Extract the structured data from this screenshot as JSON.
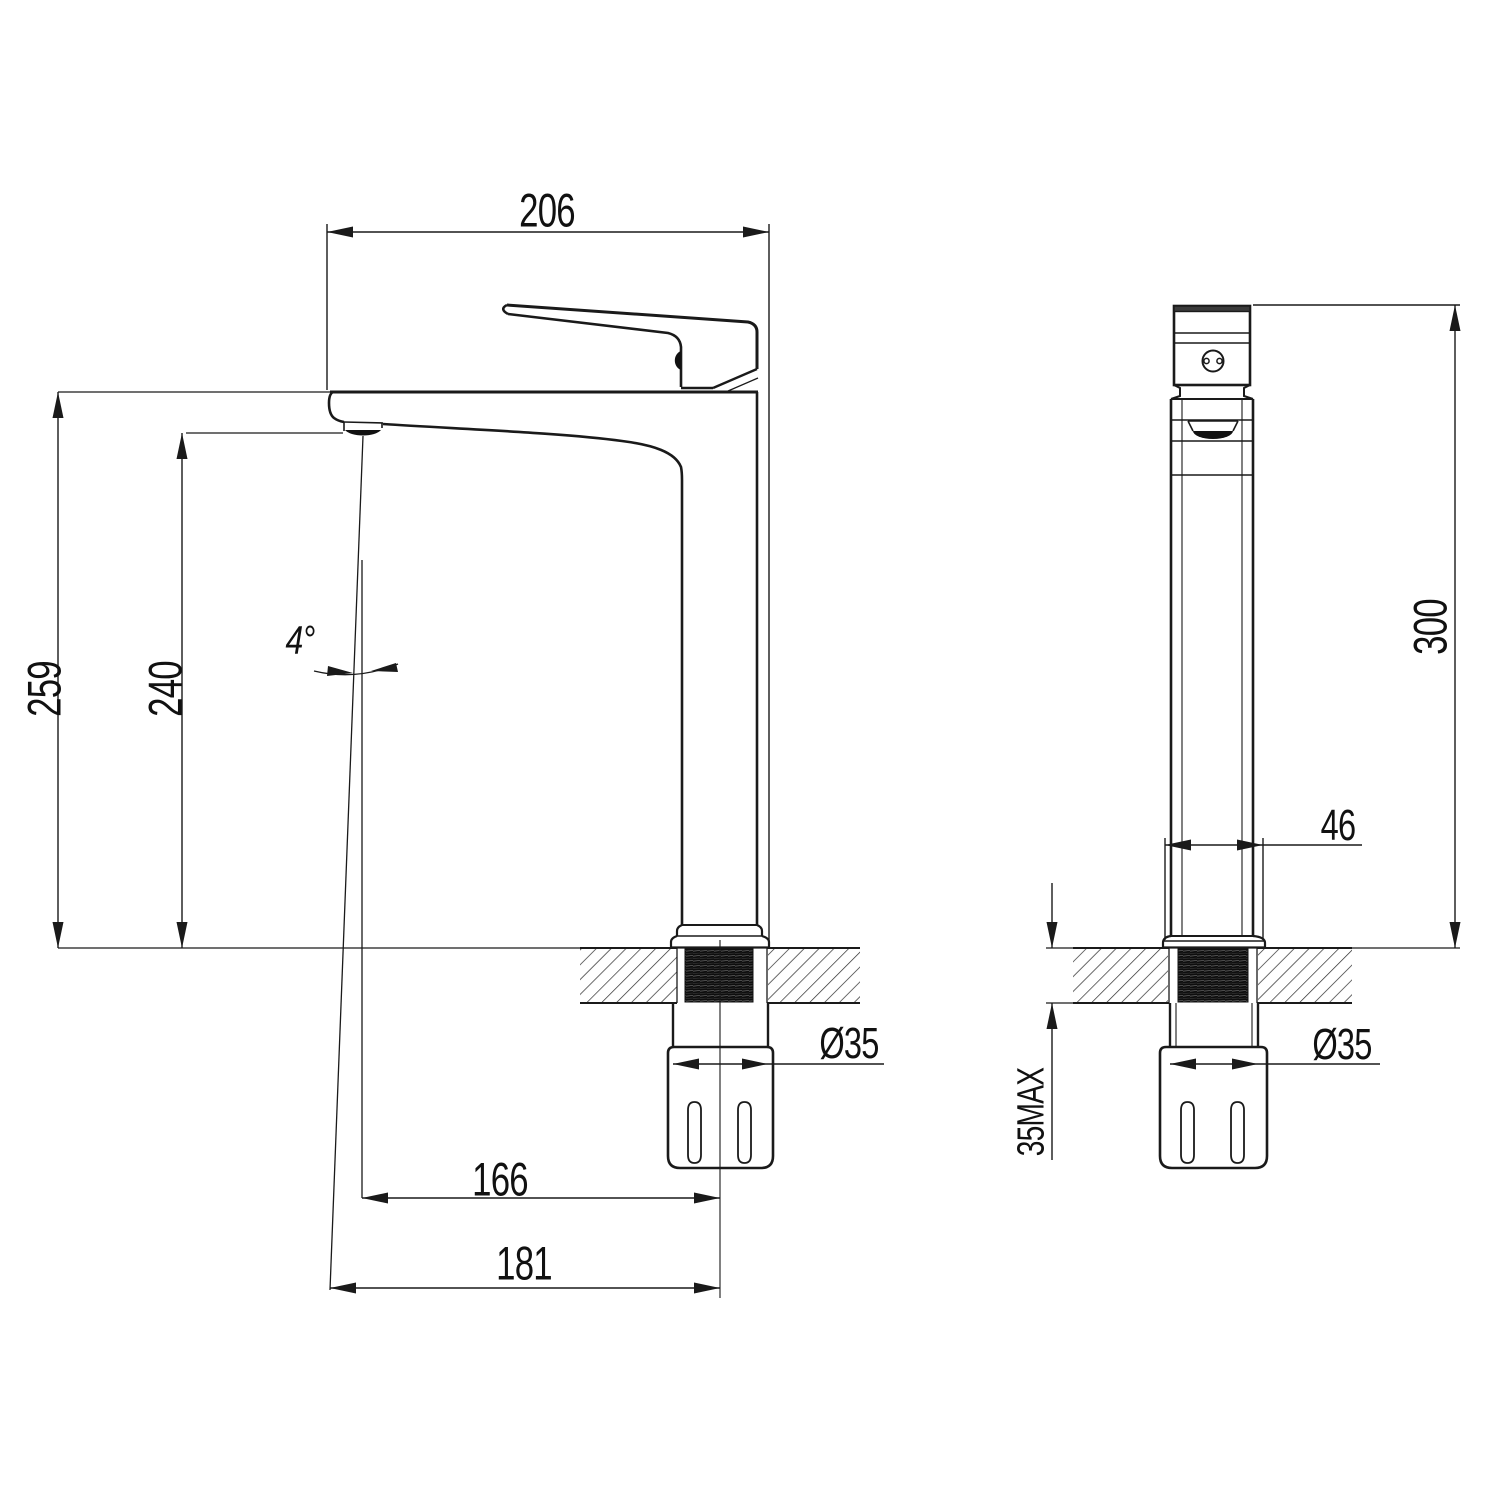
{
  "drawing": {
    "front_view": {
      "width_label": "206",
      "height_total_label": "259",
      "height_spout_label": "240",
      "angle_label": "4°",
      "reach_spout_label": "166",
      "reach_overall_label": "181",
      "thread_label": "Ø35"
    },
    "side_view": {
      "height_label": "300",
      "body_width_label": "46",
      "counter_thickness_label": "35MAX",
      "thread_label": "Ø35"
    },
    "line_color": "#1a1a1a",
    "background_color": "#ffffff"
  }
}
